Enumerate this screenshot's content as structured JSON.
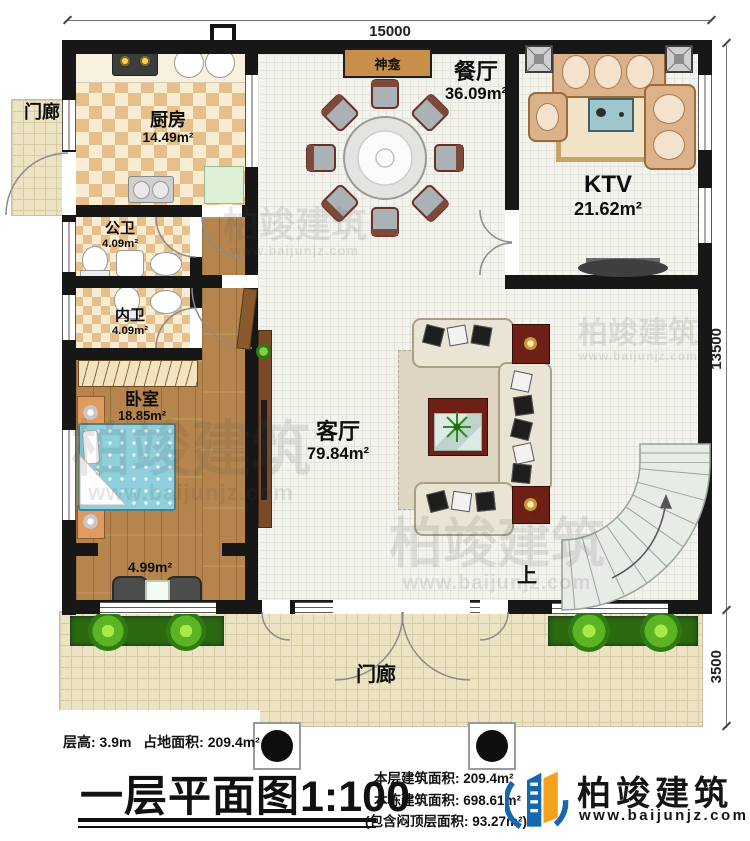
{
  "plan": {
    "dim_top": "15000",
    "dim_right_upper": "13500",
    "dim_right_lower": "3500",
    "rooms": {
      "kitchen": {
        "name": "厨房",
        "area": "14.49m²"
      },
      "public_bath": {
        "name": "公卫",
        "area": "4.09m²"
      },
      "private_bath": {
        "name": "内卫",
        "area": "4.09m²"
      },
      "bedroom": {
        "name": "卧室",
        "area": "18.85m²"
      },
      "bay": {
        "area": "4.99m²"
      },
      "living": {
        "name": "客厅",
        "area": "79.84m²"
      },
      "dining": {
        "name": "餐厅",
        "area": "36.09m²"
      },
      "ktv": {
        "name": "KTV",
        "area": "21.62m²"
      },
      "shrine": {
        "name": "神龛"
      },
      "porch_left": {
        "name": "门廊"
      },
      "porch_bottom": {
        "name": "门廊"
      },
      "stairs": {
        "label": "上"
      }
    }
  },
  "footer": {
    "floor_height": "层高: 3.9m",
    "site_area": "占地面积: 209.4m²",
    "title": "一层平面图",
    "scale": "1:100",
    "stat_floor": "本层建筑面积: 209.4m²",
    "stat_building": "本栋建筑面积: 698.61m²",
    "stat_attic": "(包含闷顶层面积: 93.27m²)"
  },
  "brand": {
    "name": "柏竣建筑",
    "url": "www.baijunjz.com"
  }
}
